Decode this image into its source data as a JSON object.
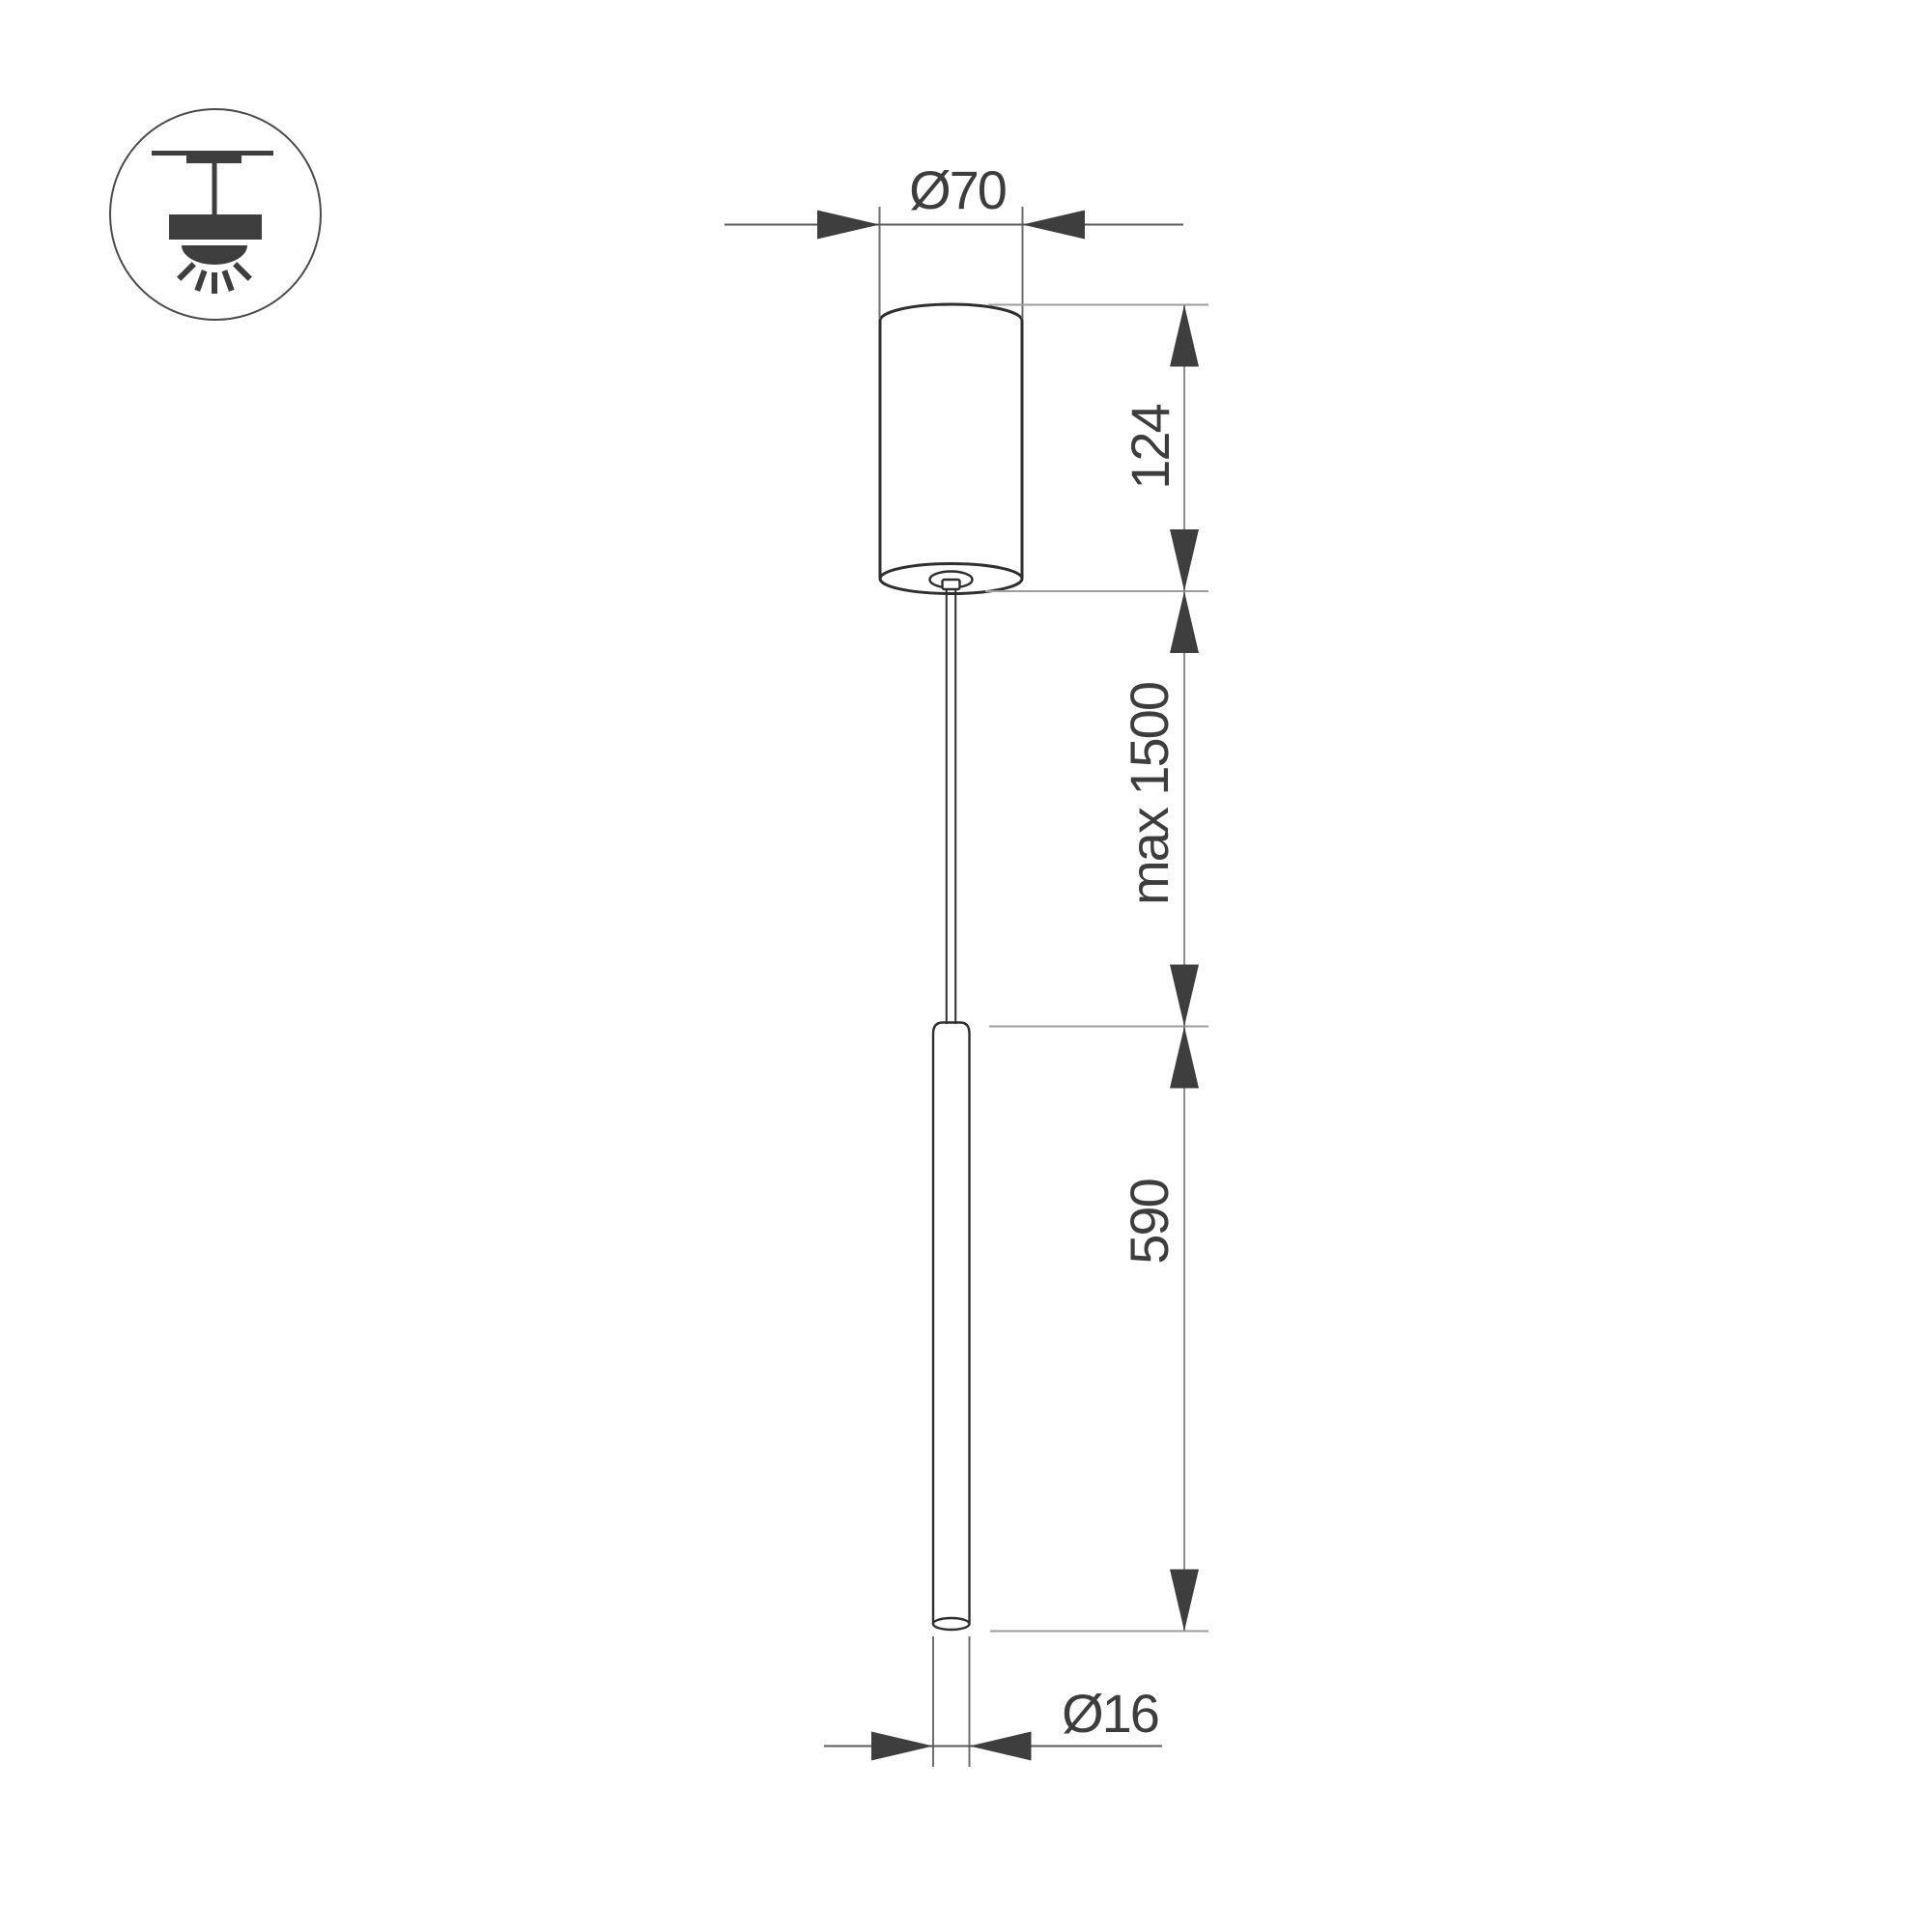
{
  "drawing": {
    "type": "pendant-lamp-dimension-drawing",
    "dimensions": {
      "canopy_diameter": "Ø70",
      "canopy_height": "124",
      "suspension_max_length": "max 1500",
      "tube_length": "590",
      "tube_diameter": "Ø16"
    },
    "icon": {
      "name": "ceiling-mount-pendant-icon",
      "meaning": "surface ceiling mounted pendant luminaire"
    },
    "colors": {
      "background": "#ffffff",
      "product_outline": "#2f2f2f",
      "arrowheads": "#3e3e3e",
      "dimension_lines": "#5a5a5a",
      "reference_lines": "#9e9e9e",
      "extension_lines": "#6e6e6e",
      "text": "#3d3d3d"
    }
  }
}
